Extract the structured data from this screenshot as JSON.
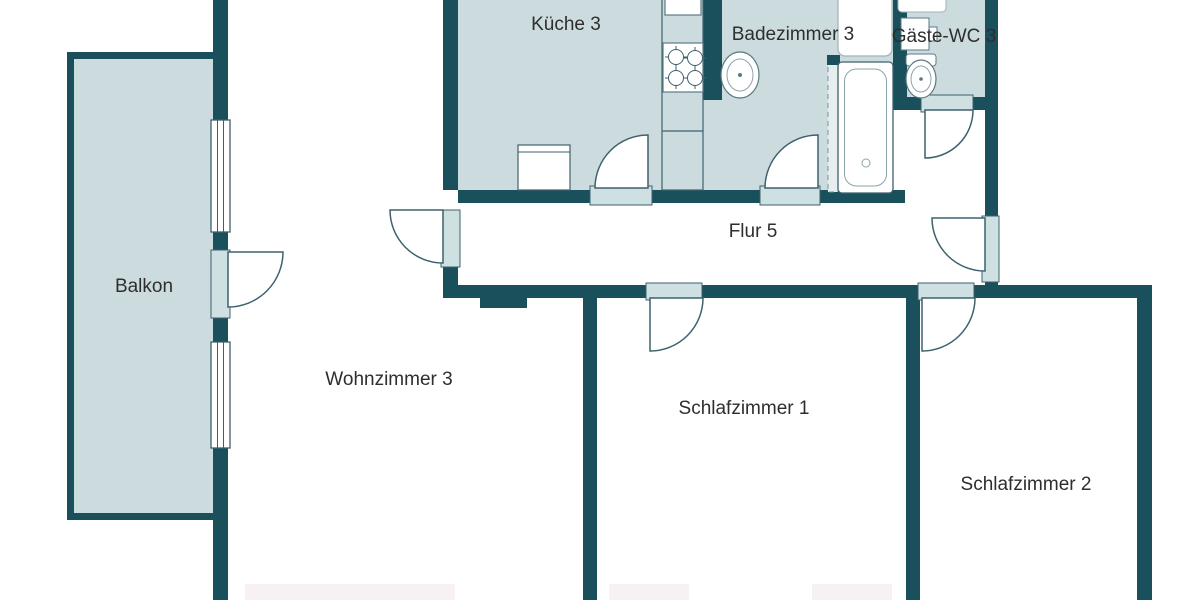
{
  "plan": {
    "type": "apartment-floor-plan",
    "language": "de",
    "rooms": [
      {
        "label": "Küche 3"
      },
      {
        "label": "Badezimmer 3"
      },
      {
        "label": "Gäste-WC 3"
      },
      {
        "label": "Flur 5"
      },
      {
        "label": "Balkon"
      },
      {
        "label": "Wohnzimmer 3"
      },
      {
        "label": "Schlafzimmer 1"
      },
      {
        "label": "Schlafzimmer 2"
      }
    ],
    "colors": {
      "wall": "#1a505c",
      "room_fill": "#ccdcde",
      "door_sill": "#cfe0e3",
      "outline": "#3e616d",
      "fixture_outline": "#5a7a84",
      "background": "#ffffff",
      "label_text": "#2e2e2e"
    },
    "fixtures": [
      "kitchen-sink",
      "stove",
      "kitchen-appliance",
      "bathroom-sink",
      "washbasin",
      "shower-screen",
      "bathtub",
      "toilet",
      "wc-sink"
    ],
    "features": {
      "windows": 2,
      "door_swings": 8
    }
  }
}
